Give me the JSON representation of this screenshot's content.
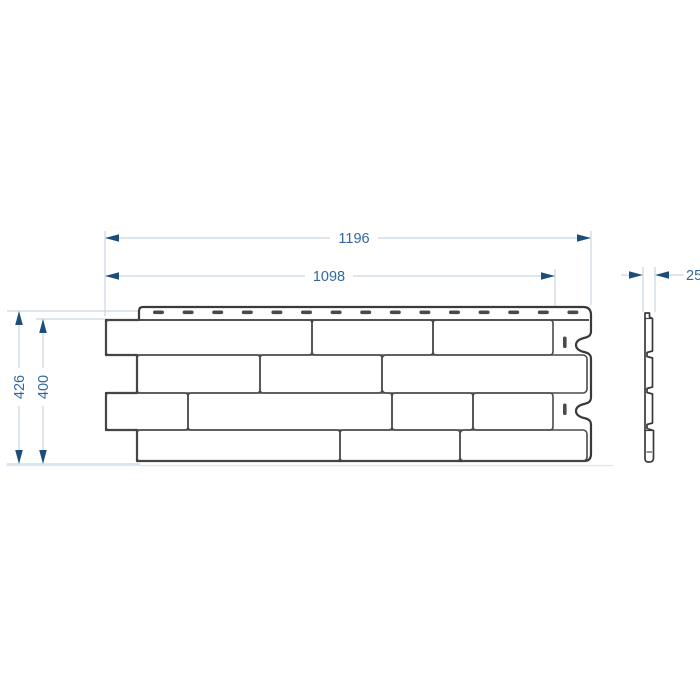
{
  "drawing": {
    "type": "technical-dimension-drawing",
    "subject": "brick-pattern facade panel (front view and side profile)",
    "dimensions": {
      "outer_width": "1196",
      "inner_width": "1098",
      "outer_height": "426",
      "inner_height": "400",
      "thickness": "25"
    },
    "views": {
      "front_view": "panel with 4 staggered brick courses, top nail hem with 15 slots, wavy right edge with 2 vertical slots",
      "side_view": "thin stepped profile, thickness 25"
    },
    "colors": {
      "background": "#ffffff",
      "panel_outline": "#3a3a3a",
      "brick_line": "#4a4a4a",
      "dimension_line": "#c9d6e2",
      "dimension_arrow": "#1d4e7a",
      "dimension_text": "#31699e"
    }
  }
}
